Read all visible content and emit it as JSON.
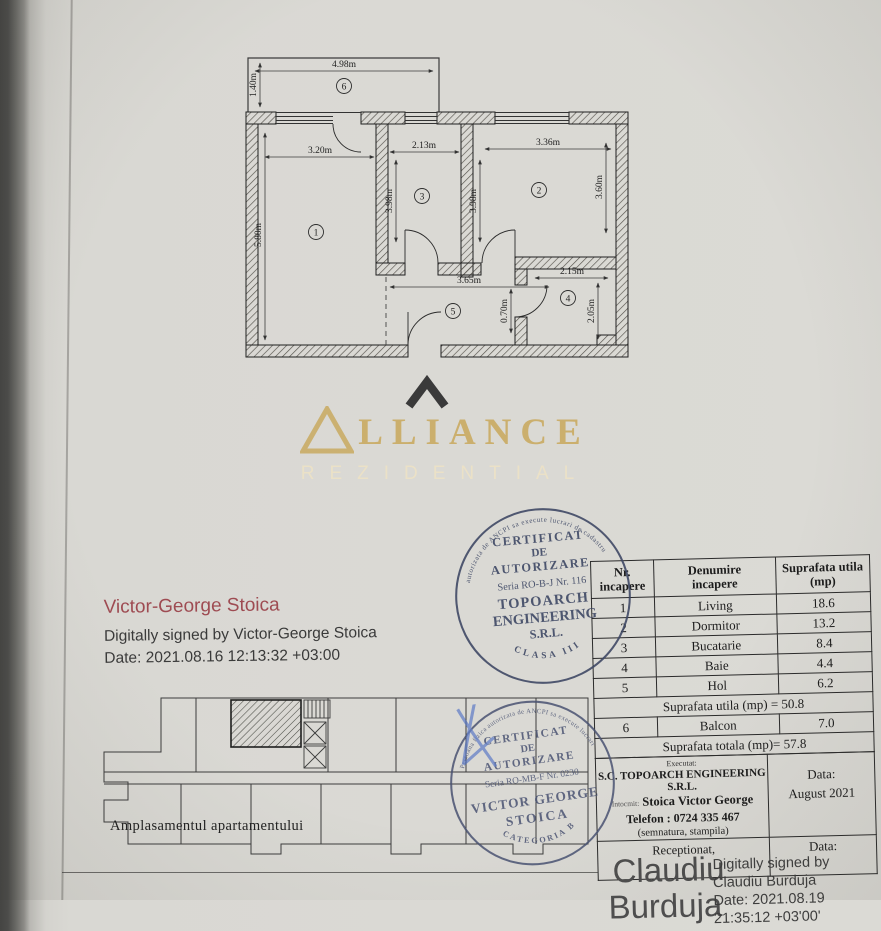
{
  "plan": {
    "d498": "4.98m",
    "d140": "1.40m",
    "d320": "3.20m",
    "d213": "2.13m",
    "d336": "3.36m",
    "d580": "5.80m",
    "d398a": "3.98m",
    "d398b": "3.98m",
    "d360": "3.60m",
    "d365": "3.65m",
    "d215": "2.15m",
    "d205": "2.05m",
    "d070": "0.70m",
    "r1": "1",
    "r2": "2",
    "r3": "3",
    "r4": "4",
    "r5": "5",
    "r6": "6"
  },
  "logo": {
    "brand": "LLIANCE",
    "sub": "REZIDENTIAL"
  },
  "stamp1": {
    "arc_top": "autorizata de ANCPI sa execute lucrari de cadastru",
    "l1": "CERTIFICAT",
    "l2": "DE",
    "l3": "AUTORIZARE",
    "l4": "Seria RO-B-J Nr. 116",
    "l5": "TOPOARCH",
    "l6": "ENGINEERING",
    "l7": "S.R.L.",
    "arc_bottom": "CLASA III"
  },
  "signer": {
    "name": "Victor-George Stoica",
    "line1": "Digitally signed by Victor-George Stoica",
    "line2": "Date: 2021.08.16 12:13:32 +03:00"
  },
  "table": {
    "h1a": "Nr.",
    "h1b": "incapere",
    "h2a": "Denumire",
    "h2b": "incapere",
    "h3a": "Suprafata utila",
    "h3b": "(mp)",
    "rows": [
      {
        "nr": "1",
        "name": "Living",
        "area": "18.6"
      },
      {
        "nr": "2",
        "name": "Dormitor",
        "area": "13.2"
      },
      {
        "nr": "3",
        "name": "Bucatarie",
        "area": "8.4"
      },
      {
        "nr": "4",
        "name": "Baie",
        "area": "4.4"
      },
      {
        "nr": "5",
        "name": "Hol",
        "area": "6.2"
      }
    ],
    "subtotal": "Suprafata utila (mp) = 50.8",
    "balcony": {
      "nr": "6",
      "name": "Balcon",
      "area": "7.0"
    },
    "total": "Suprafata totala (mp)= 57.8"
  },
  "stamp2": {
    "arc_top": "Persoana fizica autorizata de ANCPI sa execute lucrari",
    "l1": "CERTIFICAT",
    "l2": "DE",
    "l3": "AUTORIZARE",
    "l4": "Seria RO-MB-F Nr. 0230",
    "l5": "VICTOR GEORGE",
    "l6": "STOICA",
    "arc_bottom": "CATEGORIA B"
  },
  "site": {
    "caption": "Amplasamentul apartamentului"
  },
  "exec": {
    "label": "Executat:",
    "company": "S.C. TOPOARCH ENGINEERING S.R.L.",
    "by_label": "Intocmit:",
    "name": "Stoica Victor George",
    "phone": "Telefon : 0724 335 467",
    "note": "(semnatura, stampila)",
    "date_label": "Data:",
    "date": "August 2021"
  },
  "recv": {
    "label": "Receptionat,",
    "sig1": "Claudiu",
    "sig2": "Burduja",
    "date_label": "Data:",
    "ds1": "Digitally signed by",
    "ds2": "Claudiu Burduja",
    "ds3": "Date: 2021.08.19",
    "ds4": "21:35:12 +03'00'"
  }
}
